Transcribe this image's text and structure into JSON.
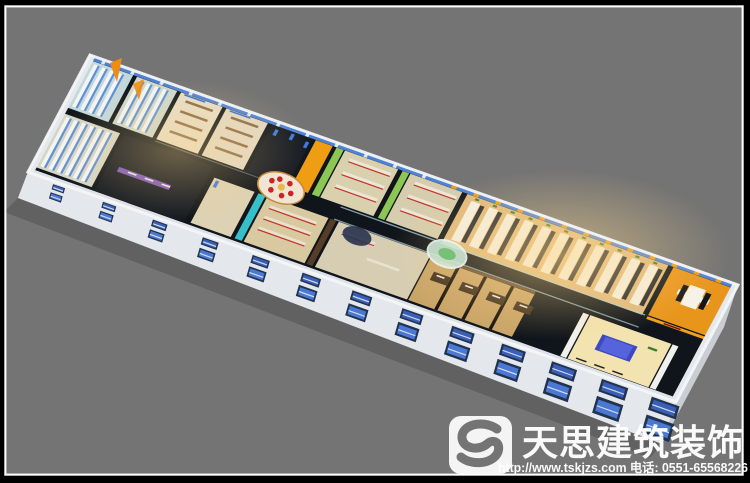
{
  "image": {
    "kind": "3d-isometric-office-interior-rendering",
    "background_color": "#747474",
    "frame_outer_color": "#000000",
    "frame_inner_line_color": "#ffffff"
  },
  "watermark": {
    "logo_icon": "s-swirl-icon",
    "company": "天思建筑装饰",
    "url": "http://www.tskjzs.com",
    "phone_label": "电话:",
    "phone": "0551-65568226",
    "contact_line": "http://www.tskjzs.com 电话: 0551-65568226",
    "text_color": "#ffffff"
  },
  "palette": {
    "corridor_black": "#10151b",
    "sky_window_blue": "#4d82d8",
    "facade_window_blue": "#4a78d4",
    "facade_frame_dark": "#223350",
    "column_orange": "#ef9d13",
    "conference_orange": "#e8951c",
    "open_office_floor": "#e0ba7e",
    "classroom_floor": "#e6dcc6",
    "green_wall": "#8cc653",
    "teal_wall": "#35bfc8",
    "purple_wall": "#7d58b8",
    "brown_office_floor": "#c9a468",
    "brown_wall": "#6b4a2e",
    "blue_table": "#3d49c0",
    "red_chair": "#c5302a",
    "stall_blue": "#5f8fd8",
    "desk_white": "#f4f1e6",
    "glass_green": "#cfe8d4",
    "wall_white": "#e4e8ec"
  }
}
